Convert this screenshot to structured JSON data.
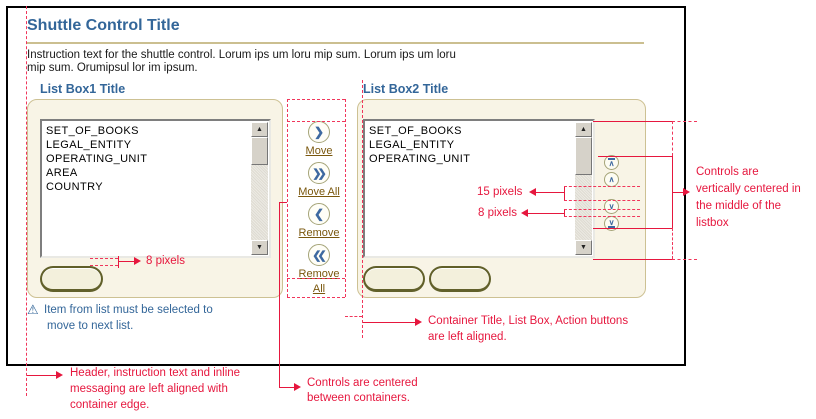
{
  "header": {
    "title": "Shuttle Control Title",
    "instruction_line1": "Instruction text for the shuttle control. Lorum ips um loru mip sum. Lorum ips um loru",
    "instruction_line2": "mip sum. Orumipsul lor im ipsum."
  },
  "list_box1": {
    "title": "List Box1 Title",
    "items": [
      "SET_OF_BOOKS",
      "LEGAL_ENTITY",
      "OPERATING_UNIT",
      "AREA",
      "COUNTRY"
    ]
  },
  "list_box2": {
    "title": "List Box2 Title",
    "items": [
      "SET_OF_BOOKS",
      "LEGAL_ENTITY",
      "OPERATING_UNIT"
    ]
  },
  "shuttle_controls": [
    {
      "icon": "❯",
      "label": "Move"
    },
    {
      "icon": "❯❯",
      "label": "Move All"
    },
    {
      "icon": "❮",
      "label": "Remove"
    },
    {
      "icon": "❮❮",
      "label": "Remove All"
    }
  ],
  "reorder_controls": [
    {
      "glyph": "∧",
      "name": "move-to-top"
    },
    {
      "glyph": "∧",
      "name": "move-up"
    },
    {
      "glyph": "∨",
      "name": "move-down"
    },
    {
      "glyph": "∨",
      "name": "move-to-bottom"
    }
  ],
  "scrollbar": {
    "up": "▲",
    "down": "▼"
  },
  "warning": {
    "icon": "⚠",
    "line1": "Item from list must be selected to",
    "line2": "move to next list."
  },
  "annotations": {
    "accent_red": "#E6173E",
    "title_blue": "#336699",
    "measure_8px_left": "8 pixels",
    "measure_15px": "15 pixels",
    "measure_8px_right": "8 pixels",
    "vertical_center": [
      "Controls are",
      "vertically centered in",
      "the middle of the",
      "listbox"
    ],
    "container_aligned": [
      "Container Title, List Box, Action buttons",
      "are left aligned."
    ],
    "header_aligned": [
      "Header, instruction text and inline",
      "messaging are left aligned with",
      "container edge."
    ],
    "controls_centered": [
      "Controls are centered",
      "between containers."
    ]
  }
}
